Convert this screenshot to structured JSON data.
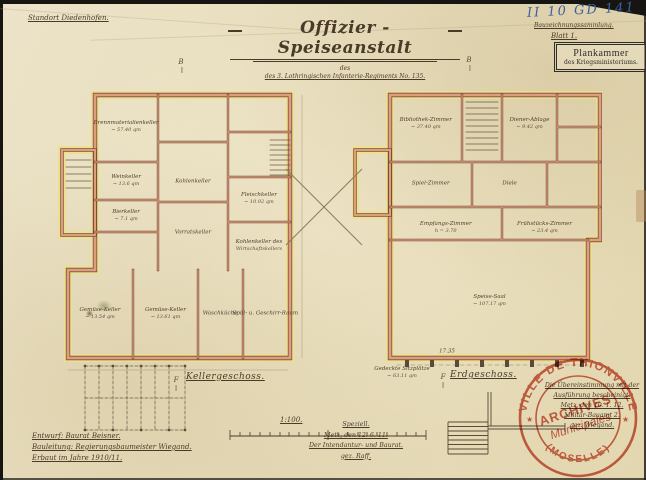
{
  "page": {
    "standort": "Standort Diedenhofen.",
    "title": "Offizier - Speiseanstalt",
    "title_sub_word": "des",
    "subtitle": "des 3. Lothringischen Infanterie-Regiments No. 135.",
    "archive_no": "II 10 GD 141",
    "archive_note": "Bauzeichnungssammlung.",
    "blatt": "Blatt 1.",
    "plankammer": {
      "line1": "Plankammer",
      "line2": "des Kriegsministeriums."
    },
    "scale": "1:100.",
    "credits": {
      "line1": "Entwurf: Baurat Beisner.",
      "line2": "Bauleitung: Regierungsbaumeister Wiegand.",
      "line3": "Erbaut im Jahre 1910/11."
    },
    "approval_center": {
      "line1": "Speziell.",
      "line2": "Metz, den 12. 6. 11.",
      "line3": "Der Intendantur- und Baurat.",
      "line4": "gez. Raff."
    },
    "approval_right": {
      "line1": "Die Übereinstimmung mit der",
      "line2": "Ausführung bescheinigt.",
      "line3": "Metz, den 10. 1. 12.",
      "line4": "Militär-Bauamt 2.",
      "line5": "gez. Wiegand."
    },
    "city_stamp": {
      "arc_top": "VILLE DE THIONVILLE",
      "center1": "ARCHIVES",
      "center2": "Municipales",
      "arc_bottom": "(MOSELLE)",
      "star": "★"
    }
  },
  "plans": [
    {
      "title": "Kellergeschoss.",
      "rooms": [
        {
          "label": "Brennmaterialienkeller",
          "area": "~ 57.40 qm",
          "x": 26.6,
          "y": 12.5
        },
        {
          "label": "Weinkeller",
          "area": "~ 13.6 qm",
          "x": 26.6,
          "y": 27.5
        },
        {
          "label": "Bierkeller",
          "area": "~ 7.1 qm",
          "x": 26.6,
          "y": 37.2
        },
        {
          "label": "Kohlenkeller",
          "area": "",
          "x": 52.7,
          "y": 27.8
        },
        {
          "label": "Vorratskeller",
          "area": "",
          "x": 52.7,
          "y": 42
        },
        {
          "label": "Fleischkeller",
          "area": "~ 10.92 qm",
          "x": 78.5,
          "y": 32.5
        },
        {
          "label": "Kohlenkeller des",
          "area": "Wirtschaftskellers",
          "x": 78.5,
          "y": 45.5
        },
        {
          "label": "Gemüse-Keller",
          "area": "~ 13.54 qm",
          "x": 16.4,
          "y": 64.5
        },
        {
          "label": "Gemüse-Keller",
          "area": "~ 13.61 qm",
          "x": 42,
          "y": 64.5
        },
        {
          "label": "Waschküche",
          "area": "",
          "x": 63.3,
          "y": 64.5
        },
        {
          "label": "Spül- u. Geschirr-Raum",
          "area": "",
          "x": 81,
          "y": 64.5
        }
      ]
    },
    {
      "title": "Erdgeschoss.",
      "rooms": [
        {
          "label": "Bibliothek-Zimmer",
          "area": "~ 37.40 qm",
          "x": 29.5,
          "y": 14
        },
        {
          "label": "Diener-Ablage",
          "area": "~ 9.42 qm",
          "x": 71,
          "y": 14
        },
        {
          "label": "Spiel-Zimmer",
          "area": "",
          "x": 31.5,
          "y": 34
        },
        {
          "label": "Diele",
          "area": "",
          "x": 63,
          "y": 34
        },
        {
          "label": "Empfangs-Zimmer",
          "area": "h = 3.70",
          "x": 37.5,
          "y": 48.5
        },
        {
          "label": "Frühstücks-Zimmer",
          "area": "~ 23.4 qm",
          "x": 77,
          "y": 48.5
        },
        {
          "label": "Speise-Saal",
          "area": "~ 107.17 qm",
          "x": 55,
          "y": 73
        },
        {
          "label": "17.35",
          "area": "",
          "x": 38,
          "y": 90
        },
        {
          "label": "Gedeckte Sitzplätze",
          "area": "~ 63.11 qm",
          "x": 20,
          "y": 97
        }
      ]
    }
  ],
  "markers": [
    {
      "letter": "B",
      "x": 181,
      "y": 62
    },
    {
      "letter": "B",
      "x": 469,
      "y": 60
    },
    {
      "letter": "F",
      "x": 176,
      "y": 380
    },
    {
      "letter": "F",
      "x": 443,
      "y": 377
    }
  ],
  "colors": {
    "paper": "#e9dfc0",
    "ink": "#4a3a28",
    "wall": "#dd9d7e",
    "wall_dark": "#7a4f3a",
    "highlight": "#ece189",
    "blue": "#3d5f9f",
    "stamp_red": "#c94f38"
  }
}
